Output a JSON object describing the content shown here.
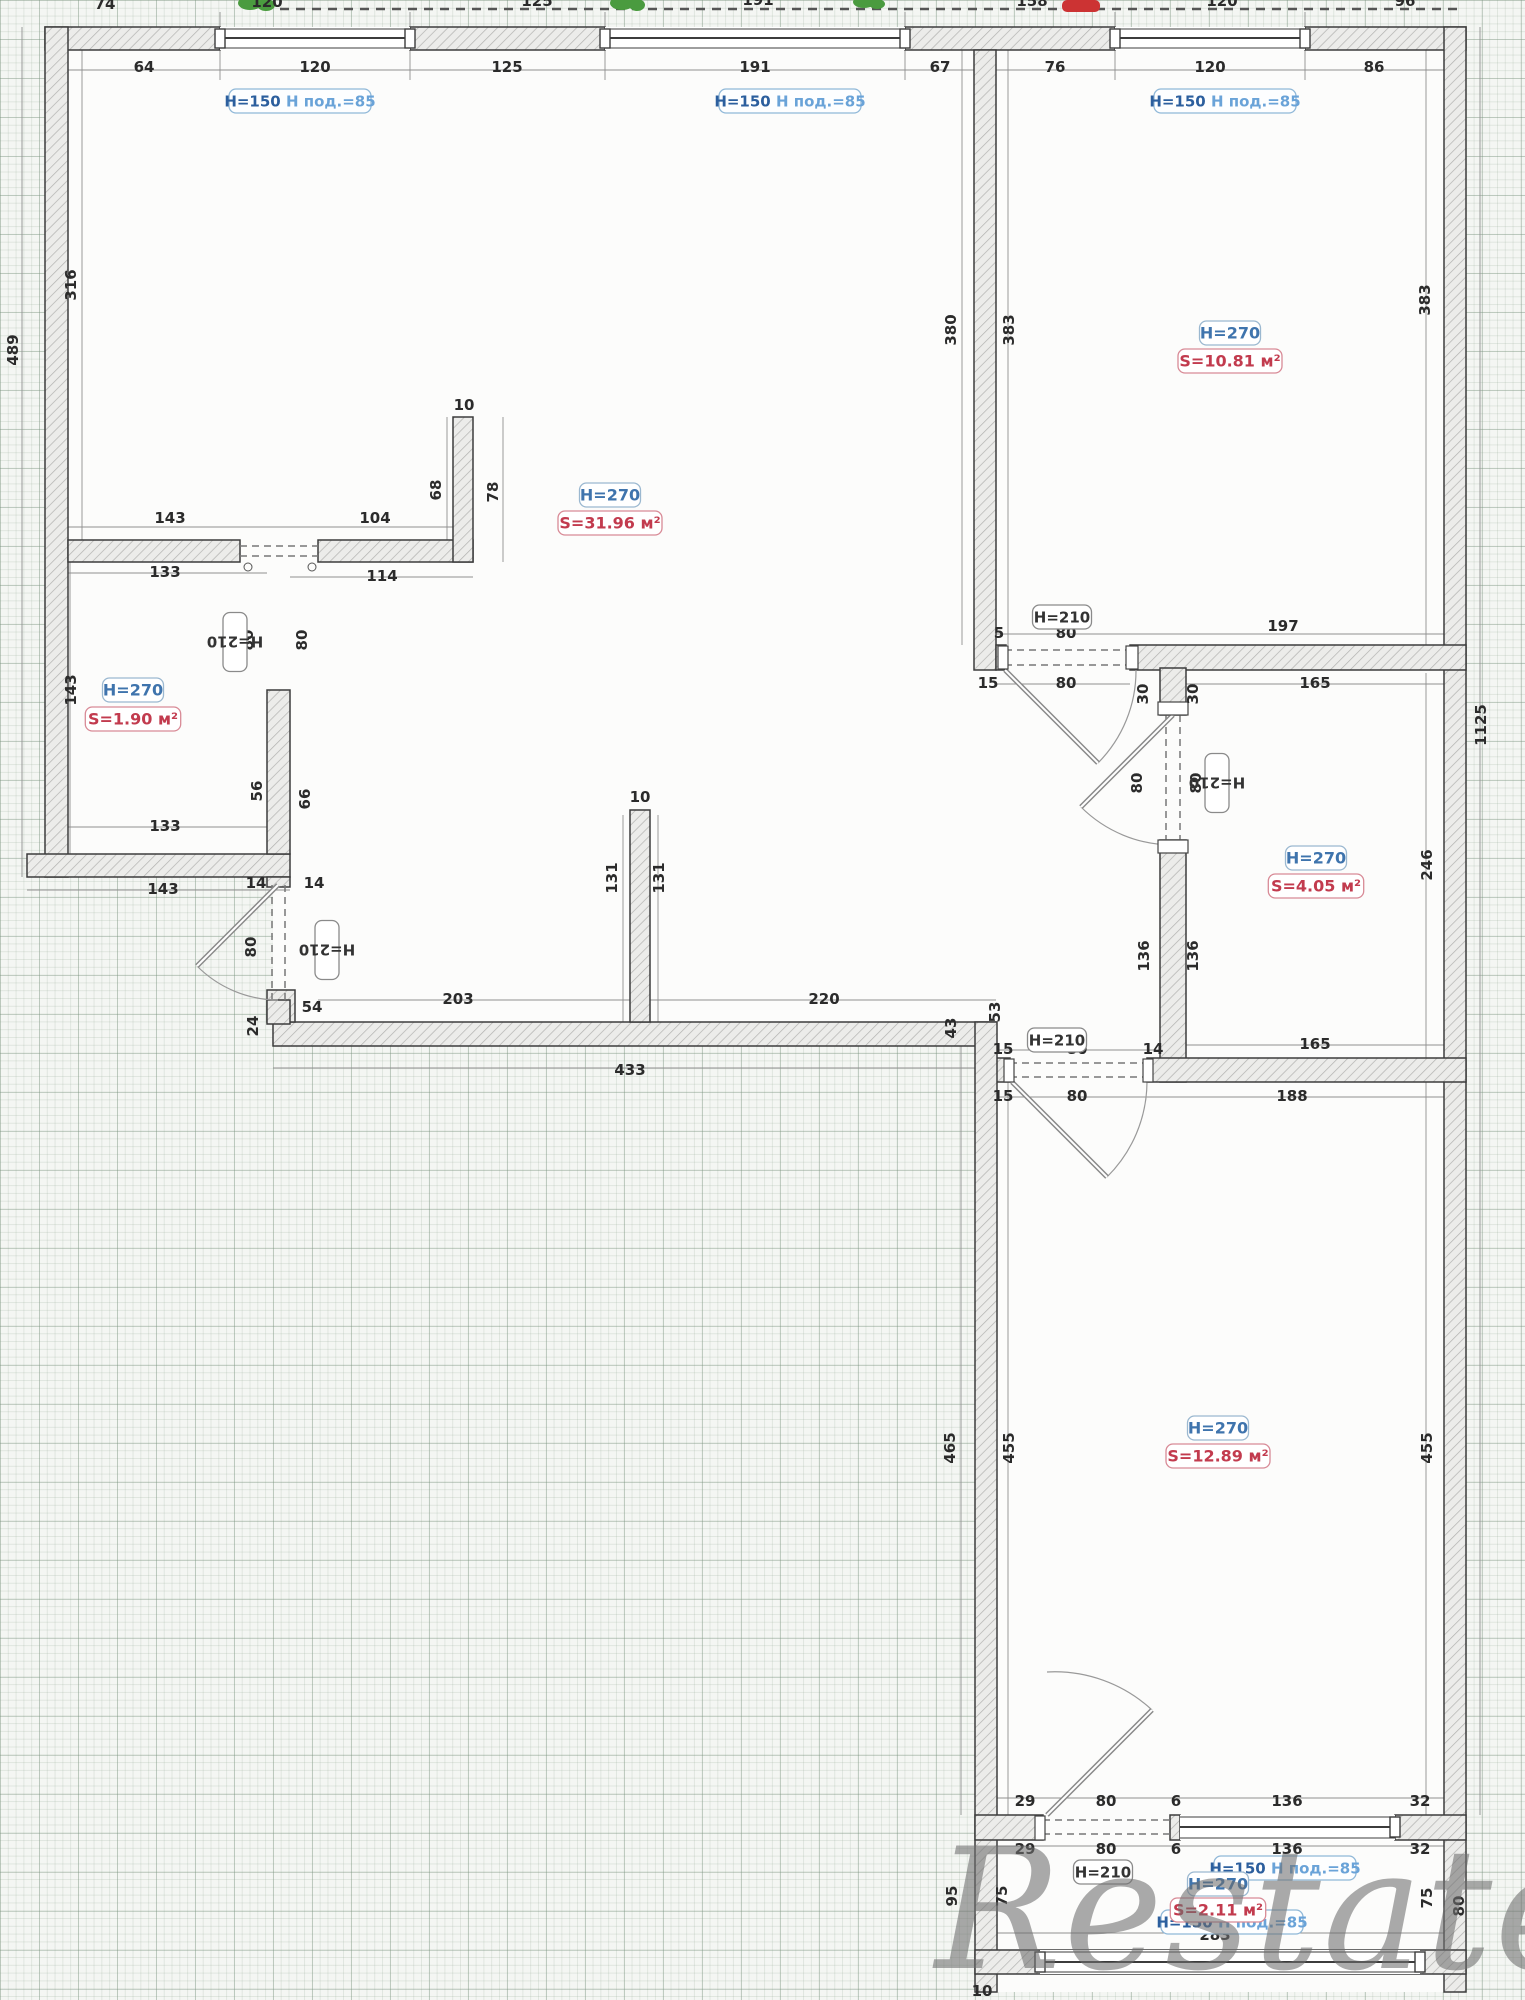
{
  "plan": {
    "watermark": "Restate",
    "colors": {
      "height_label_text": "#3f74ad",
      "area_label_text": "#c23b4e",
      "window_label_text1": "#2c5f9e",
      "window_label_text2": "#6aa3d8",
      "door_label_text": "#333333",
      "dim_text": "#2b2b2b",
      "plant_icon": "#4a9b3f",
      "red_mark": "#cc3333"
    },
    "rooms": [
      {
        "id": "living-room",
        "height_label": "H=270",
        "area_label": "S=31.96 м²",
        "x": 610,
        "hy": 495,
        "sy": 523
      },
      {
        "id": "room-top-right",
        "height_label": "H=270",
        "area_label": "S=10.81 м²",
        "x": 1230,
        "hy": 333,
        "sy": 361
      },
      {
        "id": "storage",
        "height_label": "H=270",
        "area_label": "S=1.90 м²",
        "x": 133,
        "hy": 690,
        "sy": 719
      },
      {
        "id": "bathroom",
        "height_label": "H=270",
        "area_label": "S=4.05 м²",
        "x": 1316,
        "hy": 858,
        "sy": 886
      },
      {
        "id": "room-bottom",
        "height_label": "H=270",
        "area_label": "S=12.89 м²",
        "x": 1218,
        "hy": 1428,
        "sy": 1456
      },
      {
        "id": "loggia",
        "height_label": "H=270",
        "area_label": "S=2.11 м²",
        "x": 1218,
        "hy": 1884,
        "sy": 1910
      }
    ],
    "window_labels": [
      {
        "t1": "H=150",
        "t2": "H под.=85",
        "x": 300,
        "y": 101
      },
      {
        "t1": "H=150",
        "t2": "H под.=85",
        "x": 790,
        "y": 101
      },
      {
        "t1": "H=150",
        "t2": "H под.=85",
        "x": 1225,
        "y": 101
      },
      {
        "t1": "H=150",
        "t2": "H под.=85",
        "x": 1285,
        "y": 1868
      },
      {
        "t1": "H=150",
        "t2": "H под.=85",
        "x": 1232,
        "y": 1922
      }
    ],
    "door_labels": [
      {
        "t": "H=210",
        "x": 235,
        "y": 642,
        "r": -90
      },
      {
        "t": "H=210",
        "x": 327,
        "y": 950,
        "r": -90
      },
      {
        "t": "H=210",
        "x": 1062,
        "y": 617,
        "r": 0
      },
      {
        "t": "H=210",
        "x": 1217,
        "y": 783,
        "r": -90
      },
      {
        "t": "H=210",
        "x": 1057,
        "y": 1040,
        "r": 0
      },
      {
        "t": "H=210",
        "x": 1103,
        "y": 1872,
        "r": 0
      }
    ],
    "dims": [
      {
        "t": "74",
        "x": 105,
        "y": 9
      },
      {
        "t": "120",
        "x": 267,
        "y": 7
      },
      {
        "t": "125",
        "x": 537,
        "y": 6
      },
      {
        "t": "191",
        "x": 758,
        "y": 5
      },
      {
        "t": "158",
        "x": 1032,
        "y": 6
      },
      {
        "t": "120",
        "x": 1222,
        "y": 6
      },
      {
        "t": "96",
        "x": 1405,
        "y": 6
      },
      {
        "t": "64",
        "x": 144,
        "y": 72
      },
      {
        "t": "120",
        "x": 315,
        "y": 72
      },
      {
        "t": "125",
        "x": 507,
        "y": 72
      },
      {
        "t": "191",
        "x": 755,
        "y": 72
      },
      {
        "t": "67",
        "x": 940,
        "y": 72
      },
      {
        "t": "76",
        "x": 1055,
        "y": 72
      },
      {
        "t": "120",
        "x": 1210,
        "y": 72
      },
      {
        "t": "86",
        "x": 1374,
        "y": 72
      },
      {
        "t": "316",
        "x": 76,
        "y": 285,
        "r": -90
      },
      {
        "t": "489",
        "x": 18,
        "y": 350,
        "r": -90
      },
      {
        "t": "380",
        "x": 956,
        "y": 330,
        "r": -90
      },
      {
        "t": "383",
        "x": 1014,
        "y": 330,
        "r": -90
      },
      {
        "t": "383",
        "x": 1430,
        "y": 300,
        "r": -90
      },
      {
        "t": "1125",
        "x": 1486,
        "y": 725,
        "r": -90
      },
      {
        "t": "246",
        "x": 1432,
        "y": 865,
        "r": -90
      },
      {
        "t": "465",
        "x": 955,
        "y": 1448,
        "r": -90
      },
      {
        "t": "455",
        "x": 1014,
        "y": 1448,
        "r": -90
      },
      {
        "t": "455",
        "x": 1432,
        "y": 1448,
        "r": -90
      },
      {
        "t": "143",
        "x": 170,
        "y": 523
      },
      {
        "t": "104",
        "x": 375,
        "y": 523
      },
      {
        "t": "10",
        "x": 464,
        "y": 410
      },
      {
        "t": "68",
        "x": 441,
        "y": 490,
        "r": -90
      },
      {
        "t": "78",
        "x": 498,
        "y": 492,
        "r": -90
      },
      {
        "t": "114",
        "x": 382,
        "y": 581
      },
      {
        "t": "133",
        "x": 165,
        "y": 577
      },
      {
        "t": "133",
        "x": 165,
        "y": 831
      },
      {
        "t": "143",
        "x": 163,
        "y": 894
      },
      {
        "t": "143",
        "x": 76,
        "y": 690,
        "r": -90
      },
      {
        "t": "56",
        "x": 262,
        "y": 791,
        "r": -90
      },
      {
        "t": "66",
        "x": 310,
        "y": 799,
        "r": -90
      },
      {
        "t": "80",
        "x": 253,
        "y": 640,
        "r": -90
      },
      {
        "t": "80",
        "x": 307,
        "y": 640,
        "r": -90
      },
      {
        "t": "14",
        "x": 256,
        "y": 888
      },
      {
        "t": "14",
        "x": 314,
        "y": 888
      },
      {
        "t": "80",
        "x": 256,
        "y": 947,
        "r": -90
      },
      {
        "t": "24",
        "x": 258,
        "y": 1026,
        "r": -90
      },
      {
        "t": "54",
        "x": 312,
        "y": 1012
      },
      {
        "t": "203",
        "x": 458,
        "y": 1004
      },
      {
        "t": "220",
        "x": 824,
        "y": 1004
      },
      {
        "t": "433",
        "x": 630,
        "y": 1075
      },
      {
        "t": "10",
        "x": 640,
        "y": 802
      },
      {
        "t": "131",
        "x": 617,
        "y": 878,
        "r": -90
      },
      {
        "t": "131",
        "x": 664,
        "y": 878,
        "r": -90
      },
      {
        "t": "43",
        "x": 956,
        "y": 1028,
        "r": -90
      },
      {
        "t": "53",
        "x": 1000,
        "y": 1012,
        "r": -90
      },
      {
        "t": "5",
        "x": 999,
        "y": 638
      },
      {
        "t": "80",
        "x": 1066,
        "y": 638
      },
      {
        "t": "197",
        "x": 1283,
        "y": 631
      },
      {
        "t": "15",
        "x": 988,
        "y": 688
      },
      {
        "t": "80",
        "x": 1066,
        "y": 688
      },
      {
        "t": "165",
        "x": 1315,
        "y": 688
      },
      {
        "t": "30",
        "x": 1148,
        "y": 694,
        "r": -90
      },
      {
        "t": "30",
        "x": 1198,
        "y": 694,
        "r": -90
      },
      {
        "t": "80",
        "x": 1142,
        "y": 783,
        "r": -90
      },
      {
        "t": "80",
        "x": 1201,
        "y": 783,
        "r": -90
      },
      {
        "t": "136",
        "x": 1149,
        "y": 956,
        "r": -90
      },
      {
        "t": "136",
        "x": 1198,
        "y": 956,
        "r": -90
      },
      {
        "t": "165",
        "x": 1315,
        "y": 1049
      },
      {
        "t": "15",
        "x": 1003,
        "y": 1054
      },
      {
        "t": "80",
        "x": 1077,
        "y": 1054
      },
      {
        "t": "14",
        "x": 1153,
        "y": 1054
      },
      {
        "t": "15",
        "x": 1003,
        "y": 1101
      },
      {
        "t": "80",
        "x": 1077,
        "y": 1101
      },
      {
        "t": "188",
        "x": 1292,
        "y": 1101
      },
      {
        "t": "29",
        "x": 1025,
        "y": 1806
      },
      {
        "t": "80",
        "x": 1106,
        "y": 1806
      },
      {
        "t": "6",
        "x": 1176,
        "y": 1806
      },
      {
        "t": "136",
        "x": 1287,
        "y": 1806
      },
      {
        "t": "32",
        "x": 1420,
        "y": 1806
      },
      {
        "t": "29",
        "x": 1025,
        "y": 1854
      },
      {
        "t": "80",
        "x": 1106,
        "y": 1854
      },
      {
        "t": "6",
        "x": 1176,
        "y": 1854
      },
      {
        "t": "136",
        "x": 1287,
        "y": 1854
      },
      {
        "t": "32",
        "x": 1420,
        "y": 1854
      },
      {
        "t": "283",
        "x": 1215,
        "y": 1940
      },
      {
        "t": "10",
        "x": 982,
        "y": 1996
      },
      {
        "t": "95",
        "x": 957,
        "y": 1896,
        "r": -90
      },
      {
        "t": "75",
        "x": 1007,
        "y": 1896,
        "r": -90
      },
      {
        "t": "75",
        "x": 1432,
        "y": 1898,
        "r": -90
      },
      {
        "t": "80",
        "x": 1464,
        "y": 1906,
        "r": -90
      }
    ]
  }
}
